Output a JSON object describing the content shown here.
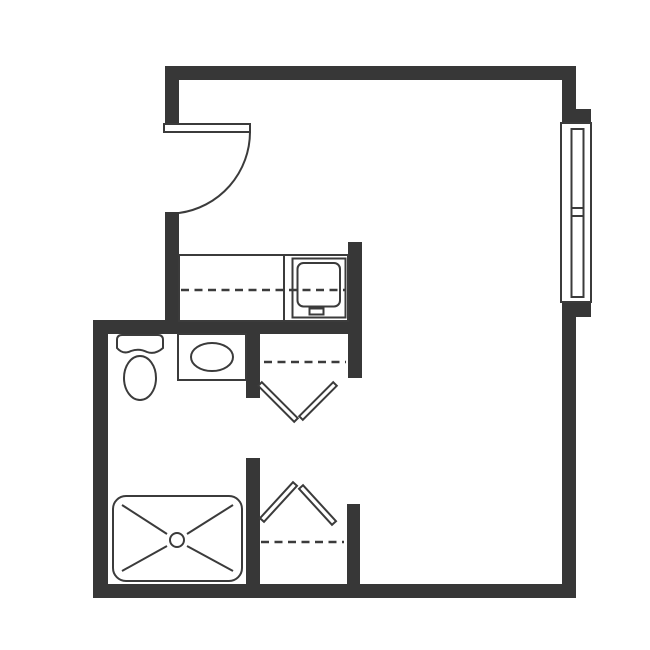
{
  "floorplan": {
    "title": "studio-apartment-floor-plan",
    "canvas": {
      "width": 650,
      "height": 650
    },
    "colors": {
      "background": "#ffffff",
      "wall": "#373737",
      "line": "#3b3b3b"
    },
    "rooms": [
      "main-room",
      "entry",
      "kitchenette",
      "bathroom",
      "closet-upper",
      "closet-lower"
    ],
    "elements": [
      {
        "name": "top-wall",
        "type": "rect",
        "cls": "wall",
        "attrs": {
          "x": 165,
          "y": 66,
          "width": 411,
          "height": 14
        }
      },
      {
        "name": "right-wall-upper",
        "type": "rect",
        "cls": "wall",
        "attrs": {
          "x": 562,
          "y": 66,
          "width": 14,
          "height": 43
        }
      },
      {
        "name": "window-jamb-top",
        "type": "rect",
        "cls": "wall",
        "attrs": {
          "x": 562,
          "y": 109,
          "width": 29,
          "height": 14
        }
      },
      {
        "name": "window-jamb-bottom",
        "type": "rect",
        "cls": "wall",
        "attrs": {
          "x": 562,
          "y": 301,
          "width": 29,
          "height": 16
        }
      },
      {
        "name": "right-wall-lower",
        "type": "rect",
        "cls": "wall",
        "attrs": {
          "x": 562,
          "y": 317,
          "width": 14,
          "height": 281
        }
      },
      {
        "name": "bottom-wall",
        "type": "rect",
        "cls": "wall",
        "attrs": {
          "x": 93,
          "y": 584,
          "width": 483,
          "height": 14
        }
      },
      {
        "name": "left-wall",
        "type": "rect",
        "cls": "wall",
        "attrs": {
          "x": 93,
          "y": 320,
          "width": 15,
          "height": 278
        }
      },
      {
        "name": "bathroom-top-wall",
        "type": "rect",
        "cls": "wall",
        "attrs": {
          "x": 93,
          "y": 320,
          "width": 269,
          "height": 14
        }
      },
      {
        "name": "entry-wall-upper",
        "type": "rect",
        "cls": "wall",
        "attrs": {
          "x": 165,
          "y": 66,
          "width": 14,
          "height": 59
        }
      },
      {
        "name": "entry-wall-lower",
        "type": "rect",
        "cls": "wall",
        "attrs": {
          "x": 165,
          "y": 212,
          "width": 14,
          "height": 122
        }
      },
      {
        "name": "kitchen-partition-wall",
        "type": "rect",
        "cls": "wall",
        "attrs": {
          "x": 348,
          "y": 242,
          "width": 14,
          "height": 136
        }
      },
      {
        "name": "bathroom-partition-upper",
        "type": "rect",
        "cls": "wall",
        "attrs": {
          "x": 246,
          "y": 334,
          "width": 14,
          "height": 64
        }
      },
      {
        "name": "bathroom-partition-lower",
        "type": "rect",
        "cls": "wall",
        "attrs": {
          "x": 246,
          "y": 458,
          "width": 14,
          "height": 126
        }
      },
      {
        "name": "closet-lower-right-wall",
        "type": "rect",
        "cls": "wall",
        "attrs": {
          "x": 347,
          "y": 504,
          "width": 13,
          "height": 80
        }
      },
      {
        "name": "entry-door-leaf",
        "type": "rect",
        "cls": "outline",
        "attrs": {
          "x": 164,
          "y": 124,
          "width": 86,
          "height": 8
        }
      },
      {
        "name": "entry-door-swing-arc",
        "type": "path",
        "cls": "stroke",
        "attrs": {
          "d": "M 250 132 A 82 82 0 0 1 179 213"
        }
      },
      {
        "name": "window-frame",
        "type": "rect",
        "cls": "outline",
        "attrs": {
          "x": 561,
          "y": 123,
          "width": 30,
          "height": 179
        }
      },
      {
        "name": "window-glazing",
        "type": "rect",
        "cls": "outline",
        "attrs": {
          "x": 571.5,
          "y": 129,
          "width": 12,
          "height": 168
        }
      },
      {
        "name": "window-meeting-rail-upper",
        "type": "line",
        "cls": "stroke",
        "attrs": {
          "x1": 571.5,
          "y1": 208,
          "x2": 583.5,
          "y2": 208
        }
      },
      {
        "name": "window-meeting-rail-lower",
        "type": "line",
        "cls": "stroke",
        "attrs": {
          "x1": 571.5,
          "y1": 216,
          "x2": 583.5,
          "y2": 216
        }
      },
      {
        "name": "kitchen-counter",
        "type": "rect",
        "cls": "outline",
        "attrs": {
          "x": 179,
          "y": 255,
          "width": 169,
          "height": 66
        }
      },
      {
        "name": "kitchen-counter-divider",
        "type": "line",
        "cls": "stroke",
        "attrs": {
          "x1": 284,
          "y1": 255,
          "x2": 284,
          "y2": 320
        }
      },
      {
        "name": "stove-outer",
        "type": "rect",
        "cls": "outline",
        "attrs": {
          "x": 292.5,
          "y": 258.5,
          "width": 53,
          "height": 59
        }
      },
      {
        "name": "stove-top",
        "type": "rect",
        "cls": "outline",
        "attrs": {
          "x": 297.5,
          "y": 263,
          "width": 42.5,
          "height": 43.5,
          "rx": 6
        }
      },
      {
        "name": "stove-drawer",
        "type": "rect",
        "cls": "outline",
        "attrs": {
          "x": 309.5,
          "y": 308.5,
          "width": 14,
          "height": 6
        }
      },
      {
        "name": "kitchen-dashed-line",
        "type": "line",
        "cls": "dash",
        "attrs": {
          "x1": 181,
          "y1": 290,
          "x2": 345,
          "y2": 290
        }
      },
      {
        "name": "toilet-tank",
        "type": "path",
        "cls": "outline",
        "attrs": {
          "d": "M 117 348 L 117 340 Q 117 335 122 335 L 158 335 Q 163 335 163 340 L 163 348 Q 155 355 147 352 Q 139 348 131 351 Q 123 355 117 348 Z"
        }
      },
      {
        "name": "toilet-bowl",
        "type": "ellipse",
        "cls": "outline",
        "attrs": {
          "cx": 140,
          "cy": 378,
          "rx": 16,
          "ry": 22
        }
      },
      {
        "name": "sink-counter",
        "type": "rect",
        "cls": "outline",
        "attrs": {
          "x": 178,
          "y": 334,
          "width": 68,
          "height": 46
        }
      },
      {
        "name": "sink-basin",
        "type": "ellipse",
        "cls": "outline",
        "attrs": {
          "cx": 212,
          "cy": 357,
          "rx": 21,
          "ry": 14
        }
      },
      {
        "name": "shower-pan",
        "type": "rect",
        "cls": "outline",
        "attrs": {
          "x": 113,
          "y": 496,
          "width": 129,
          "height": 85,
          "rx": 13
        }
      },
      {
        "name": "shower-diagonal-tl",
        "type": "line",
        "cls": "stroke",
        "attrs": {
          "x1": 122,
          "y1": 505,
          "x2": 167,
          "y2": 534
        }
      },
      {
        "name": "shower-diagonal-tr",
        "type": "line",
        "cls": "stroke",
        "attrs": {
          "x1": 233,
          "y1": 505,
          "x2": 187,
          "y2": 534
        }
      },
      {
        "name": "shower-diagonal-bl",
        "type": "line",
        "cls": "stroke",
        "attrs": {
          "x1": 122,
          "y1": 571,
          "x2": 167,
          "y2": 546
        }
      },
      {
        "name": "shower-diagonal-br",
        "type": "line",
        "cls": "stroke",
        "attrs": {
          "x1": 233,
          "y1": 571,
          "x2": 187,
          "y2": 546
        }
      },
      {
        "name": "shower-drain",
        "type": "circle",
        "cls": "outline",
        "attrs": {
          "cx": 177,
          "cy": 540,
          "r": 7
        }
      },
      {
        "name": "closet-upper-dashed-line",
        "type": "line",
        "cls": "dash",
        "attrs": {
          "x1": 264,
          "y1": 362,
          "x2": 346,
          "y2": 362
        }
      },
      {
        "name": "closet-upper-door-right",
        "type": "polygon",
        "cls": "outline",
        "attrs": {
          "points": "299.2,416.2 302.8,419.8 336.8,385.8 333.2,382.2"
        }
      },
      {
        "name": "closet-upper-door-left",
        "type": "polygon",
        "cls": "outline",
        "attrs": {
          "points": "261.8,382.2 297.8,418.2 294.2,421.8 258.2,385.8"
        }
      },
      {
        "name": "closet-lower-door-right",
        "type": "polygon",
        "cls": "outline",
        "attrs": {
          "points": "303,485.2 299,488.8 332,524.8 336,521.2"
        }
      },
      {
        "name": "closet-lower-door-left",
        "type": "polygon",
        "cls": "outline",
        "attrs": {
          "points": "260,518.2 264,521.8 297,485.8 293,482.2"
        }
      },
      {
        "name": "closet-lower-dashed-line",
        "type": "line",
        "cls": "dash",
        "attrs": {
          "x1": 261,
          "y1": 542,
          "x2": 344,
          "y2": 542
        }
      }
    ]
  }
}
